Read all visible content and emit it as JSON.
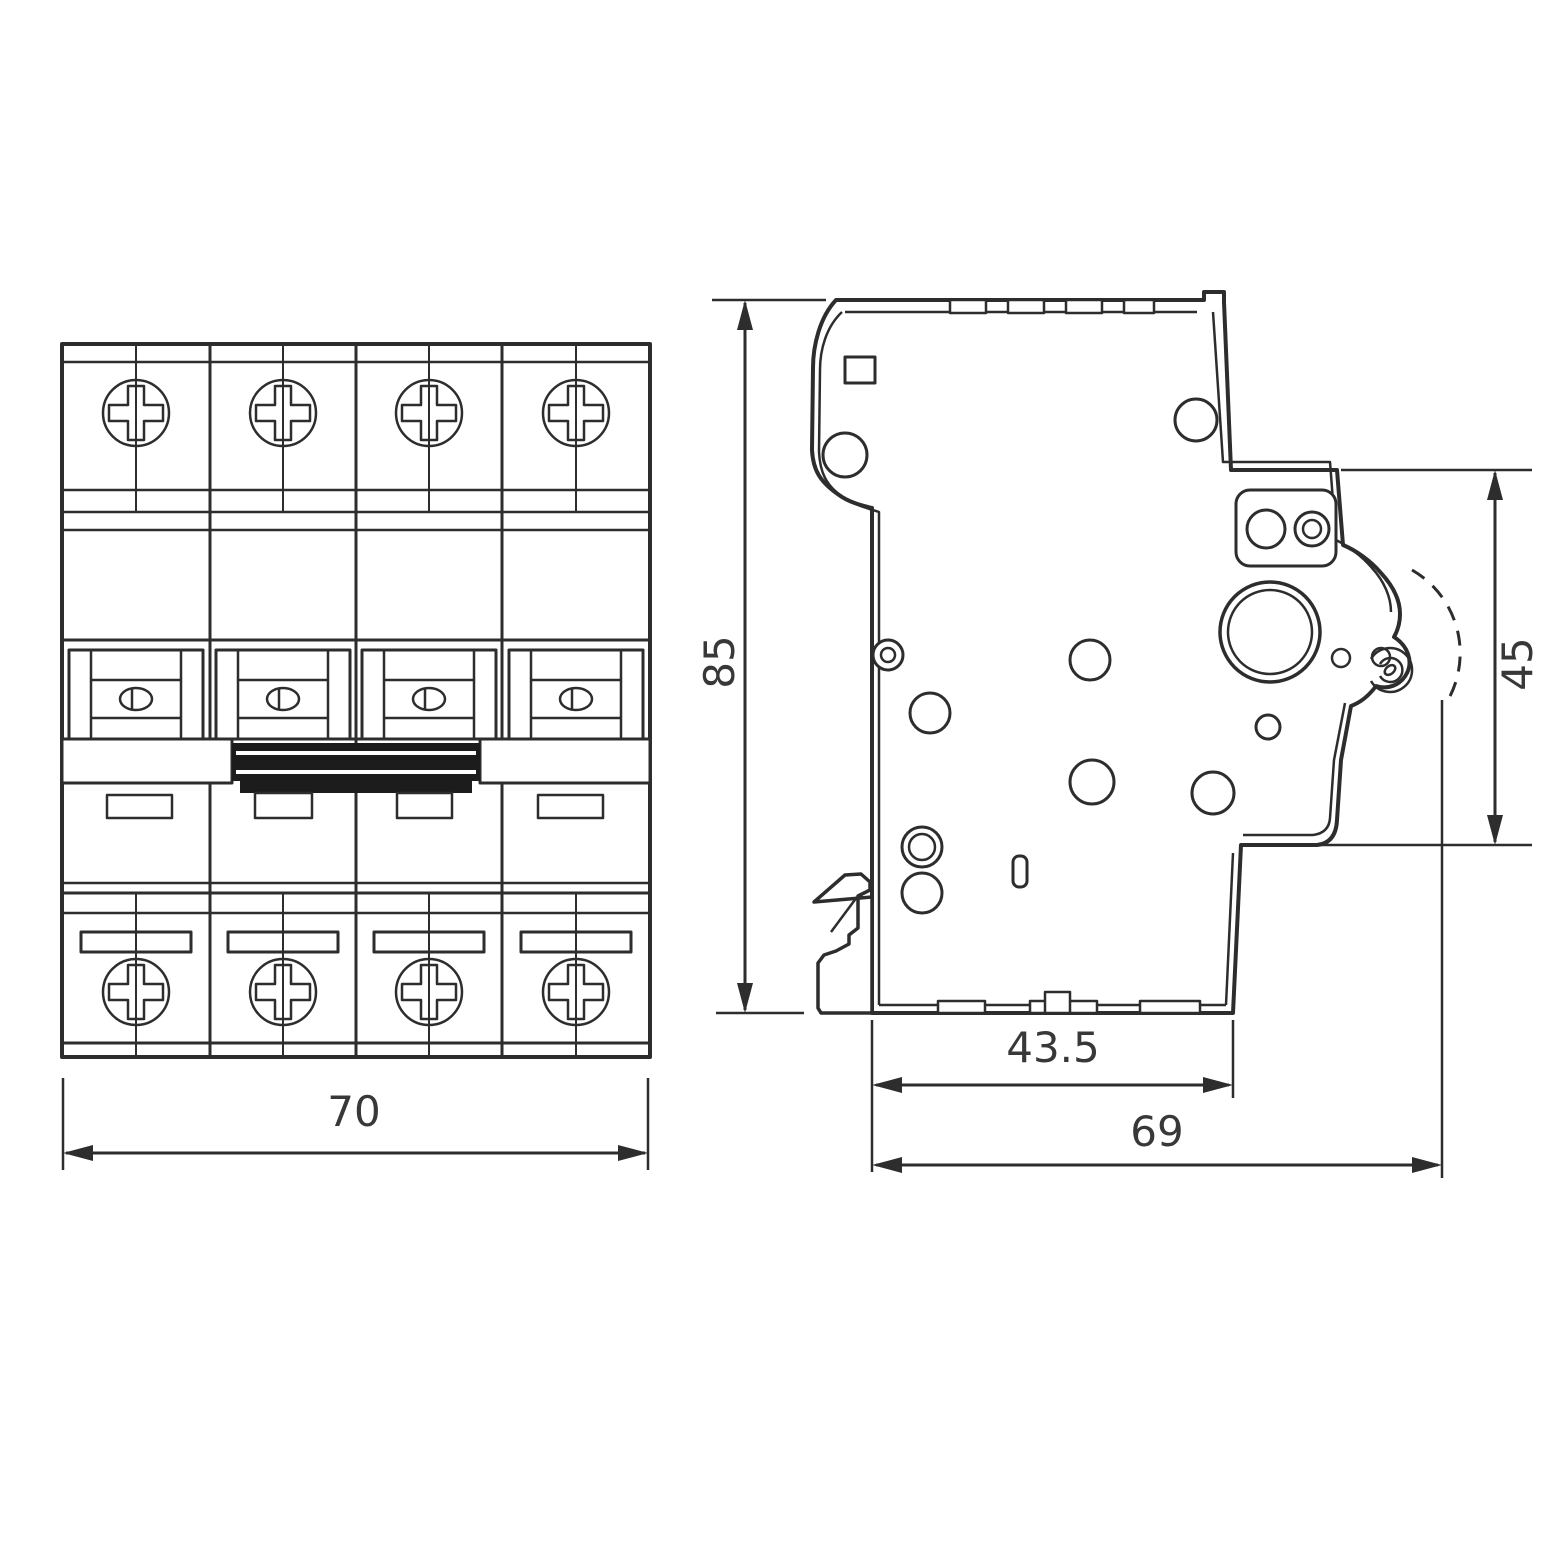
{
  "dimensions": {
    "front_width": "70",
    "side_height": "85",
    "side_handle_height": "45",
    "side_depth_body": "43.5",
    "side_depth_total": "69"
  },
  "colors": {
    "line": "#2d2d2d",
    "background": "#ffffff",
    "toggle_fill": "#1c1c1c"
  }
}
